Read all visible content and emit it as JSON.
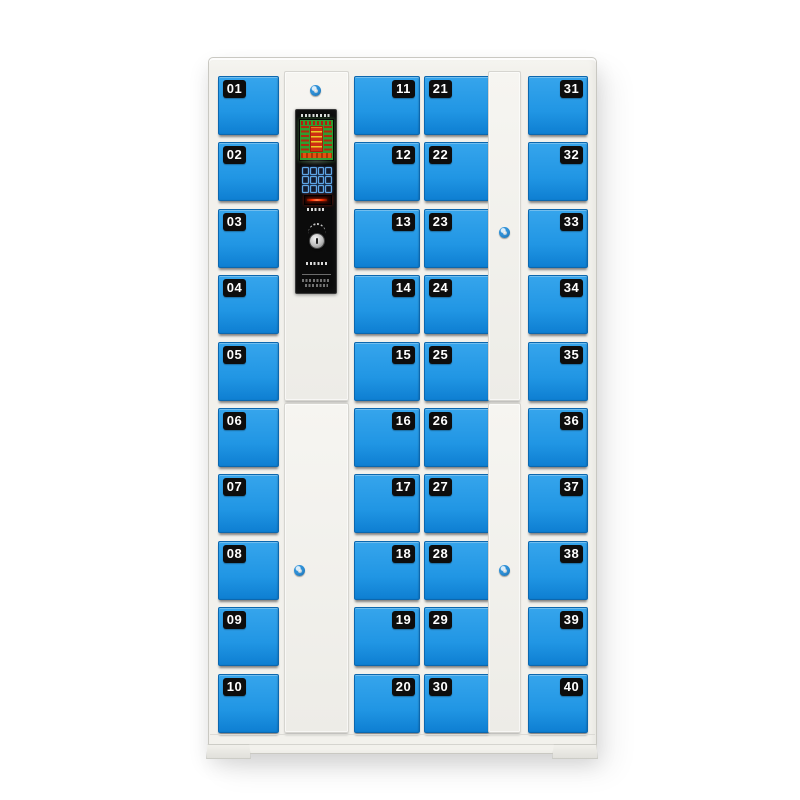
{
  "product": {
    "type": "smart-locker-cabinet",
    "door_count": 40
  },
  "theme": {
    "door_blue": "#2196E4",
    "door_blue_light": "#36A5EC",
    "door_blue_dark": "#0E7FD2",
    "door_border": "#0C67AE",
    "cabinet": "#F2F1EC",
    "cabinet_edge": "#C9C8C2",
    "label_bg": "#0D0D0D",
    "label_text": "#FFFFFF",
    "screen_green": "#2F9E30",
    "screen_red": "#CE2E12",
    "screen_orange": "#E2520E",
    "led_red": "#FF2E00",
    "key_blue": "#5FA8E8",
    "lock_blue": "#2E8FD6"
  },
  "lockers": {
    "columns": [
      {
        "id": "col-1",
        "numbers": [
          "01",
          "02",
          "03",
          "04",
          "05",
          "06",
          "07",
          "08",
          "09",
          "10"
        ]
      },
      {
        "id": "col-3",
        "numbers": [
          "11",
          "12",
          "13",
          "14",
          "15",
          "16",
          "17",
          "18",
          "19",
          "20"
        ]
      },
      {
        "id": "col-4",
        "numbers": [
          "21",
          "22",
          "23",
          "24",
          "25",
          "26",
          "27",
          "28",
          "29",
          "30"
        ]
      },
      {
        "id": "col-5",
        "numbers": [
          "31",
          "32",
          "33",
          "34",
          "35",
          "36",
          "37",
          "38",
          "39",
          "40"
        ]
      }
    ]
  },
  "panel": {
    "keypad": {
      "rows": 3,
      "cols": 4
    }
  }
}
